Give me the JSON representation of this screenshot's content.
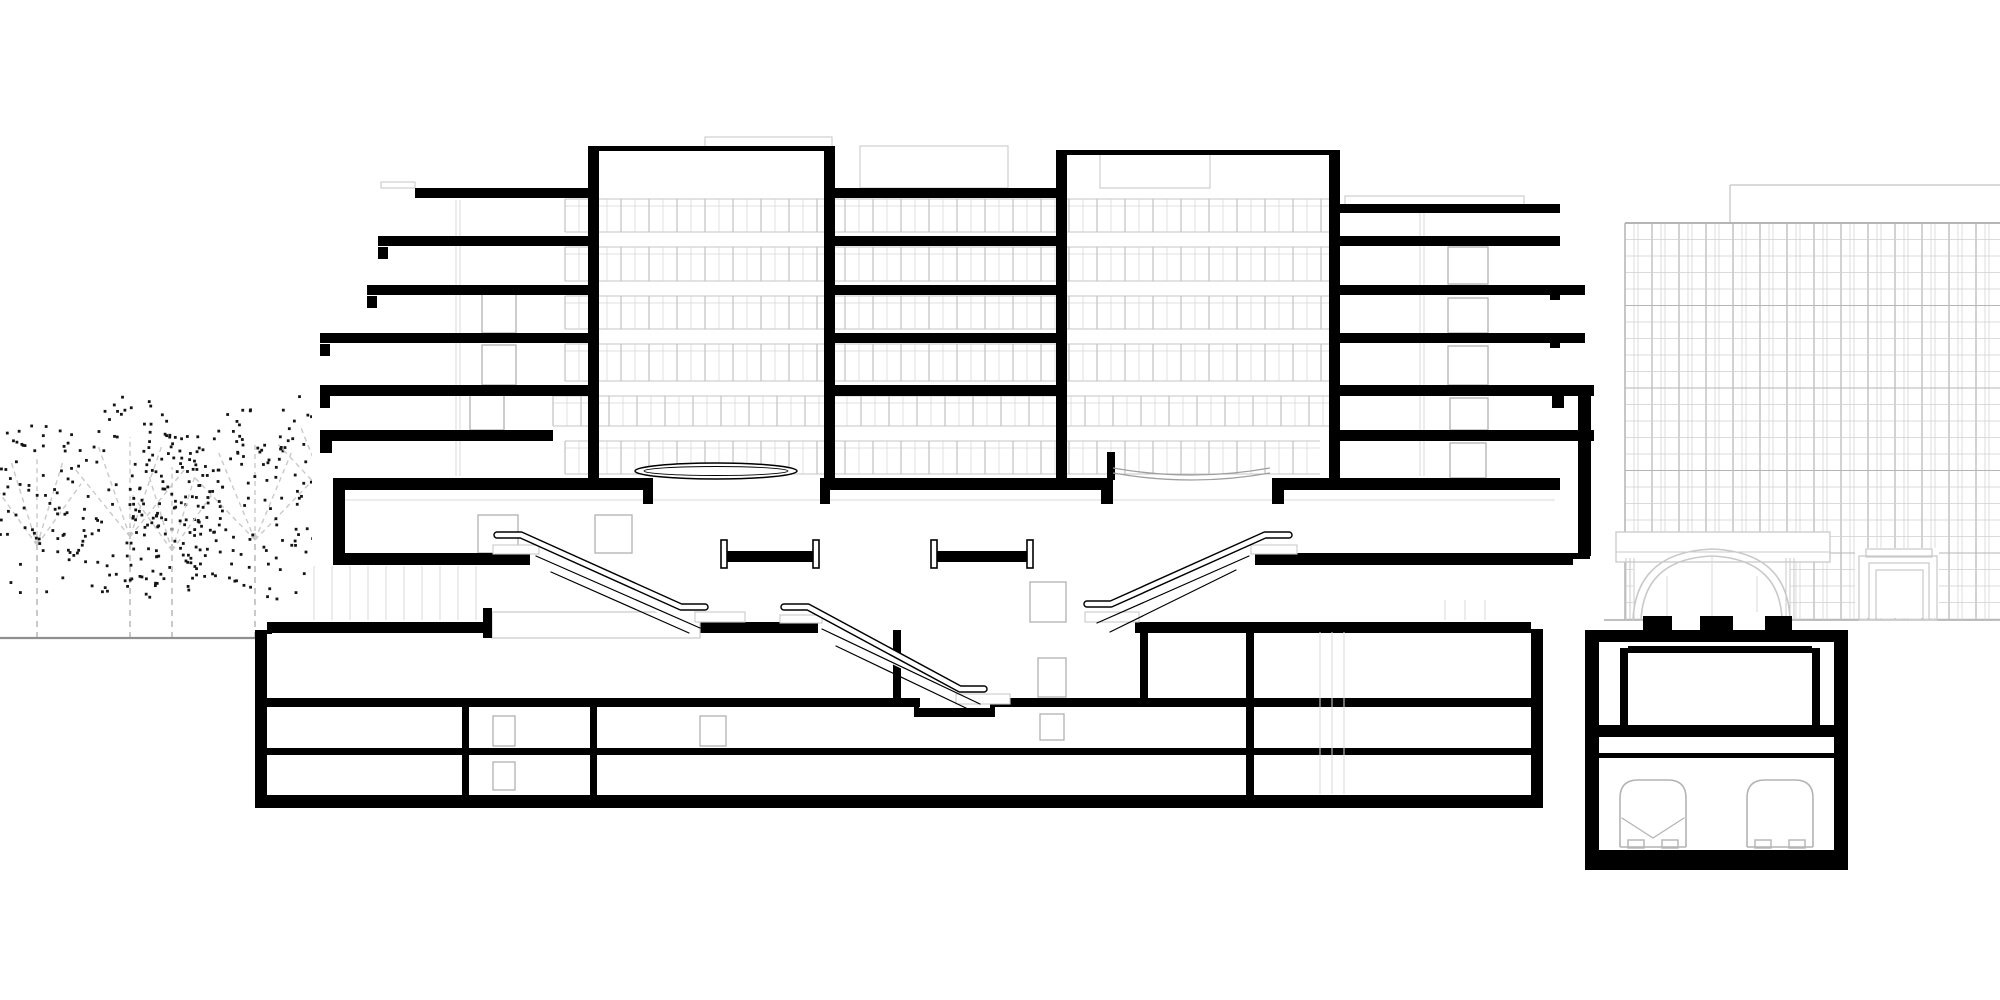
{
  "canvas": {
    "w": 2000,
    "h": 1000,
    "colors": {
      "ink": "#000000",
      "dot": "#141414",
      "branch": "#c9c9c9",
      "groundL": "#8f8f8f",
      "groundR": "#9a9a9a",
      "faint": "#c9c9c9",
      "faint2": "#d8d8d8",
      "doorline": "#b0b0b0",
      "train": "#b4b4b4",
      "bandFrame": "#c4c4c4",
      "bandMajor": "#bcbcbc",
      "bandMinor": "#d6d6d6",
      "gridMajor": "#b5b5b5",
      "gridMinor": "#cfcfcf",
      "white": "#ffffff"
    }
  },
  "trees": {
    "ground_y": 638,
    "ground_line": [
      0,
      638,
      257,
      638
    ],
    "items": [
      {
        "cx": 37,
        "cy": 512,
        "rx": 60,
        "ry": 95,
        "dots": 80,
        "seed": 11
      },
      {
        "cx": 130,
        "cy": 500,
        "rx": 75,
        "ry": 105,
        "dots": 110,
        "seed": 29
      },
      {
        "cx": 172,
        "cy": 520,
        "rx": 55,
        "ry": 88,
        "dots": 70,
        "seed": 47
      },
      {
        "cx": 255,
        "cy": 505,
        "rx": 85,
        "ry": 100,
        "dots": 120,
        "seed": 63
      },
      {
        "cx": 330,
        "cy": 470,
        "rx": 70,
        "ry": 85,
        "dots": 85,
        "seed": 81
      }
    ]
  },
  "ground_right": [
    1503,
    620,
    2000,
    620
  ],
  "building": {
    "mask": [
      312,
      128,
      1292,
      512
    ],
    "ceiling_line": [
      342,
      500,
      1555,
      500
    ],
    "bands": [
      {
        "y1": 199,
        "y2": 232,
        "x1": 565,
        "x2": 1330
      },
      {
        "y1": 247,
        "y2": 281,
        "x1": 565,
        "x2": 1330
      },
      {
        "y1": 296,
        "y2": 329,
        "x1": 565,
        "x2": 1330
      },
      {
        "y1": 344,
        "y2": 381,
        "x1": 565,
        "x2": 1330
      },
      {
        "y1": 396,
        "y2": 426,
        "x1": 553,
        "x2": 1330
      },
      {
        "y1": 441,
        "y2": 474,
        "x1": 565,
        "x2": 1320
      }
    ],
    "band_style": {
      "major_step": 28,
      "minor_off": 14,
      "transom_off": 7
    },
    "slabs": [
      {
        "y": 188,
        "h": 10,
        "segs": [
          [
            415,
            588
          ],
          [
            835,
            1056
          ]
        ]
      },
      {
        "y": 204,
        "h": 9,
        "segs": [
          [
            1340,
            1560
          ]
        ]
      },
      {
        "y": 236,
        "h": 10,
        "segs": [
          [
            378,
            588
          ],
          [
            835,
            1056
          ],
          [
            1340,
            1560
          ]
        ]
      },
      {
        "y": 285,
        "h": 10,
        "segs": [
          [
            367,
            588
          ],
          [
            835,
            1056
          ],
          [
            1340,
            1585
          ]
        ]
      },
      {
        "y": 333,
        "h": 10,
        "segs": [
          [
            320,
            588
          ],
          [
            835,
            1056
          ],
          [
            1340,
            1585
          ]
        ]
      },
      {
        "y": 385,
        "h": 11,
        "segs": [
          [
            320,
            588
          ],
          [
            835,
            1056
          ],
          [
            1340,
            1594
          ]
        ]
      },
      {
        "y": 430,
        "h": 11,
        "segs": [
          [
            320,
            553
          ],
          [
            1340,
            1594
          ]
        ]
      },
      {
        "y": 478,
        "h": 12,
        "segs": [
          [
            333,
            653
          ],
          [
            820,
            1113
          ],
          [
            1272,
            1560
          ]
        ]
      },
      {
        "y": 553,
        "h": 12,
        "segs": [
          [
            333,
            530
          ],
          [
            1255,
            1573
          ]
        ]
      },
      {
        "y": 622,
        "h": 11,
        "segs": [
          [
            267,
            483
          ],
          [
            700,
            818
          ],
          [
            1135,
            1531
          ]
        ]
      }
    ],
    "tower_tops": [
      [
        588,
        146,
        247,
        5
      ],
      [
        1056,
        150,
        284,
        5
      ]
    ],
    "walls": [
      [
        588,
        146,
        11,
        344
      ],
      [
        824,
        146,
        11,
        332
      ],
      [
        1056,
        150,
        11,
        340
      ],
      [
        1329,
        150,
        11,
        328
      ],
      [
        1107,
        452,
        8,
        28
      ]
    ],
    "end_blocks": [
      [
        378,
        247,
        10,
        12
      ],
      [
        367,
        296,
        10,
        12
      ],
      [
        320,
        344,
        10,
        12
      ],
      [
        320,
        396,
        10,
        12
      ],
      [
        320,
        441,
        12,
        12
      ],
      [
        333,
        490,
        12,
        66
      ],
      [
        643,
        490,
        10,
        14
      ],
      [
        820,
        490,
        10,
        14
      ],
      [
        1101,
        490,
        12,
        14
      ],
      [
        1272,
        490,
        12,
        14
      ],
      [
        1550,
        288,
        10,
        12
      ],
      [
        1550,
        336,
        10,
        12
      ],
      [
        1552,
        396,
        12,
        12
      ],
      [
        1578,
        392,
        13,
        164
      ],
      [
        1573,
        553,
        17,
        6
      ],
      [
        398,
        553,
        8,
        12
      ]
    ],
    "faint_rects": [
      [
        705,
        137,
        127,
        12
      ],
      [
        860,
        146,
        148,
        42
      ],
      [
        1345,
        196,
        179,
        11
      ],
      [
        381,
        182,
        34,
        6
      ],
      [
        1100,
        152,
        110,
        36
      ]
    ],
    "faint_vline_groups": [
      {
        "xs": [
          456,
          460
        ],
        "y1": 200,
        "y2": 476
      },
      {
        "xs": [
          1420,
          1424
        ],
        "y1": 207,
        "y2": 476
      },
      {
        "xs": [
          1445,
          1465,
          1485
        ],
        "y1": 600,
        "y2": 620
      }
    ],
    "storefront": {
      "x1": 314,
      "x2": 478,
      "step": 18,
      "y1": 566,
      "y2": 620
    },
    "doors": [
      [
        478,
        515,
        40,
        38
      ],
      [
        595,
        515,
        37,
        38
      ],
      [
        1030,
        582,
        36,
        40
      ],
      [
        482,
        293,
        34,
        40
      ],
      [
        482,
        345,
        34,
        40
      ],
      [
        470,
        389,
        34,
        41
      ],
      [
        1448,
        247,
        40,
        37
      ],
      [
        1448,
        298,
        40,
        35
      ],
      [
        1448,
        346,
        40,
        39
      ],
      [
        1450,
        398,
        38,
        32
      ],
      [
        1450,
        443,
        36,
        35
      ]
    ],
    "canopy_ellipse": {
      "cx": 716,
      "cy": 471,
      "rx": 81,
      "ry": 8,
      "rx2": 72,
      "ry2": 4.5
    },
    "sag_curves": [
      "M1113,468 Q1192,482 1270,468",
      "M1113,473 Q1192,487 1270,473"
    ],
    "beams": [
      {
        "x1": 727,
        "x2": 813
      },
      {
        "x1": 937,
        "x2": 1027
      }
    ],
    "beam_style": {
      "web_y": 551,
      "web_h": 11,
      "post_y": 540,
      "post_h": 28,
      "post_w": 6
    }
  },
  "basement": {
    "left_wall": [
      255,
      630,
      12,
      177
    ],
    "bottom_slab": [
      255,
      795,
      1288,
      13
    ],
    "right_wall": [
      1531,
      629,
      12,
      166
    ],
    "floors_L1": [
      [
        267,
        698,
        653,
        9
      ],
      [
        990,
        698,
        541,
        9
      ]
    ],
    "pit": [
      918,
      708,
      76,
      9
    ],
    "pit_walls": [
      [
        914,
        698,
        5,
        19
      ],
      [
        990,
        698,
        5,
        19
      ]
    ],
    "floor_B2": [
      267,
      748,
      1264,
      7
    ],
    "partitions": [
      [
        462,
        707,
        7,
        88
      ],
      [
        590,
        707,
        7,
        88
      ],
      [
        893,
        630,
        8,
        68
      ],
      [
        1140,
        630,
        8,
        77
      ],
      [
        1246,
        629,
        8,
        166
      ]
    ],
    "steps": [
      [
        257,
        634,
        8,
        4
      ],
      [
        264,
        630,
        8,
        4
      ],
      [
        271,
        626,
        8,
        4
      ],
      [
        278,
        622,
        8,
        4
      ]
    ],
    "post": [
      483,
      608,
      9,
      30
    ],
    "walkway": [
      492,
      612,
      208,
      26
    ],
    "doors": [
      [
        493,
        716,
        22,
        30
      ],
      [
        493,
        762,
        22,
        28
      ],
      [
        700,
        716,
        26,
        30
      ],
      [
        1038,
        658,
        28,
        39
      ],
      [
        1040,
        714,
        24,
        26
      ]
    ],
    "shaft_lines": {
      "xs": [
        1320,
        1332,
        1344
      ],
      "y1": 632,
      "y2": 794
    }
  },
  "escalators": {
    "quads": [
      [
        [
          521,
          537
        ],
        [
          697,
          613
        ],
        [
          697,
          631
        ],
        [
          536,
          556
        ]
      ],
      [
        [
          808,
          609
        ],
        [
          978,
          692
        ],
        [
          978,
          707
        ],
        [
          822,
          629
        ]
      ],
      [
        [
          1265,
          537
        ],
        [
          1109,
          606
        ],
        [
          1109,
          621
        ],
        [
          1251,
          556
        ]
      ]
    ],
    "rails": [
      [
        [
          497,
          535
        ],
        [
          521,
          535
        ],
        [
          681,
          607
        ],
        [
          705,
          607
        ]
      ],
      [
        [
          784,
          607
        ],
        [
          808,
          607
        ],
        [
          960,
          689
        ],
        [
          984,
          689
        ]
      ],
      [
        [
          1289,
          535
        ],
        [
          1265,
          535
        ],
        [
          1111,
          604
        ],
        [
          1087,
          604
        ]
      ]
    ],
    "lines": [
      [
        [
          536,
          556
        ],
        [
          700,
          628
        ]
      ],
      [
        [
          551,
          572
        ],
        [
          689,
          633
        ]
      ],
      [
        [
          822,
          629
        ],
        [
          980,
          704
        ]
      ],
      [
        [
          836,
          646
        ],
        [
          968,
          709
        ]
      ],
      [
        [
          1249,
          556
        ],
        [
          1097,
          623
        ]
      ],
      [
        [
          1236,
          570
        ],
        [
          1110,
          632
        ]
      ]
    ],
    "plates": [
      [
        493,
        545,
        46,
        9
      ],
      [
        1251,
        545,
        46,
        9
      ],
      [
        695,
        612,
        50,
        10
      ],
      [
        1085,
        612,
        54,
        10
      ],
      [
        956,
        694,
        54,
        10
      ],
      [
        780,
        615,
        42,
        8
      ]
    ]
  },
  "tunnel": {
    "left_wall": [
      1585,
      630,
      14,
      240
    ],
    "right_wall": [
      1834,
      630,
      14,
      240
    ],
    "bottom_slab": [
      1585,
      850,
      263,
      20
    ],
    "top_band": [
      1585,
      630,
      263,
      12
    ],
    "stubs": [
      [
        1643,
        616,
        29,
        26
      ],
      [
        1700,
        616,
        33,
        26
      ],
      [
        1765,
        616,
        27,
        26
      ]
    ],
    "gap_masks": [
      [
        1672,
        612,
        28,
        18
      ],
      [
        1733,
        612,
        32,
        18
      ]
    ],
    "inner_walls": [
      [
        1620,
        648,
        8,
        77
      ],
      [
        1812,
        648,
        8,
        77
      ]
    ],
    "inner_top": [
      1628,
      646,
      184,
      7
    ],
    "mid_slab": [
      1599,
      725,
      235,
      12
    ],
    "thin_slab": [
      1599,
      753,
      235,
      5
    ],
    "trains": {
      "spans": [
        [
          1620,
          1686
        ],
        [
          1747,
          1813
        ]
      ],
      "ytop": 780,
      "ybot": 847,
      "r": 18,
      "feet": [
        [
          1628,
          840,
          16,
          8
        ],
        [
          1662,
          840,
          16,
          8
        ],
        [
          1755,
          840,
          16,
          8
        ],
        [
          1789,
          840,
          16,
          8
        ]
      ],
      "chevrons": [
        [
          1622,
          818,
          1653,
          838,
          1684,
          818
        ]
      ]
    }
  },
  "arch": {
    "white_masks": [
      [
        1616,
        532,
        214,
        30
      ],
      [
        1633,
        560,
        157,
        58
      ],
      [
        1855,
        548,
        84,
        70
      ]
    ],
    "fascia": {
      "rect": [
        1616,
        532,
        214,
        30
      ],
      "line": [
        1616,
        552,
        1830,
        552
      ]
    },
    "arcs": [
      "M1633,620 Q1636,552 1712,549 Q1788,552 1790,620",
      "M1641,620 Q1644,559 1712,556 Q1780,559 1782,620"
    ],
    "columns": {
      "xs": [
        1626,
        1630,
        1634,
        1786,
        1790,
        1794
      ],
      "y1": 558,
      "y2": 620
    },
    "mullions": [
      [
        1667,
        576,
        1667,
        620
      ],
      [
        1712,
        557,
        1712,
        620
      ],
      [
        1757,
        576,
        1757,
        620
      ]
    ],
    "portal_rects": [
      [
        1859,
        556,
        78,
        64
      ],
      [
        1866,
        549,
        66,
        8
      ],
      [
        1869,
        563,
        60,
        57
      ],
      [
        1876,
        570,
        47,
        50
      ]
    ]
  },
  "bg_tower": {
    "x1": 1625,
    "x2": 2000,
    "y1": 223,
    "y2": 620,
    "vstep": 27,
    "voffsets": [
      0,
      9,
      13
    ],
    "hstep": 16.5,
    "parapet": [
      [
        1625,
        223,
        2000,
        223,
        2
      ],
      [
        1730,
        185,
        2000,
        185,
        1
      ],
      [
        1730,
        185,
        1730,
        223,
        1
      ],
      [
        1625,
        223,
        1625,
        620,
        1.4
      ]
    ]
  }
}
